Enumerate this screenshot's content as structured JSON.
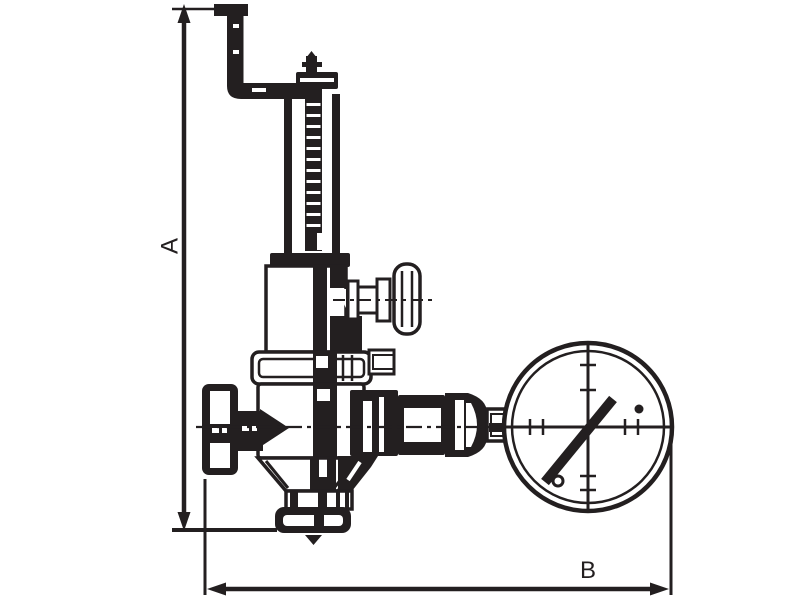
{
  "canvas": {
    "width": 800,
    "height": 598,
    "background": "#ffffff",
    "ink": "#231f20"
  },
  "diagram": {
    "type": "technical-line-drawing"
  },
  "labels": {
    "dim_vertical": "A",
    "dim_horizontal": "B"
  },
  "parts": [
    "lever-handle",
    "adjusting-screw-pin",
    "spring-housing",
    "threaded-spindle",
    "yoke-bonnet",
    "t-handle",
    "upper-body-flange",
    "side-stub",
    "valve-body",
    "inlet-cap",
    "outlet-neck",
    "outlet-flange",
    "gauge-connection-pipe",
    "union-nut",
    "gauge-nipple",
    "pressure-gauge",
    "gauge-dial",
    "gauge-needle",
    "dimension-line-a",
    "dimension-line-b",
    "centerline"
  ]
}
